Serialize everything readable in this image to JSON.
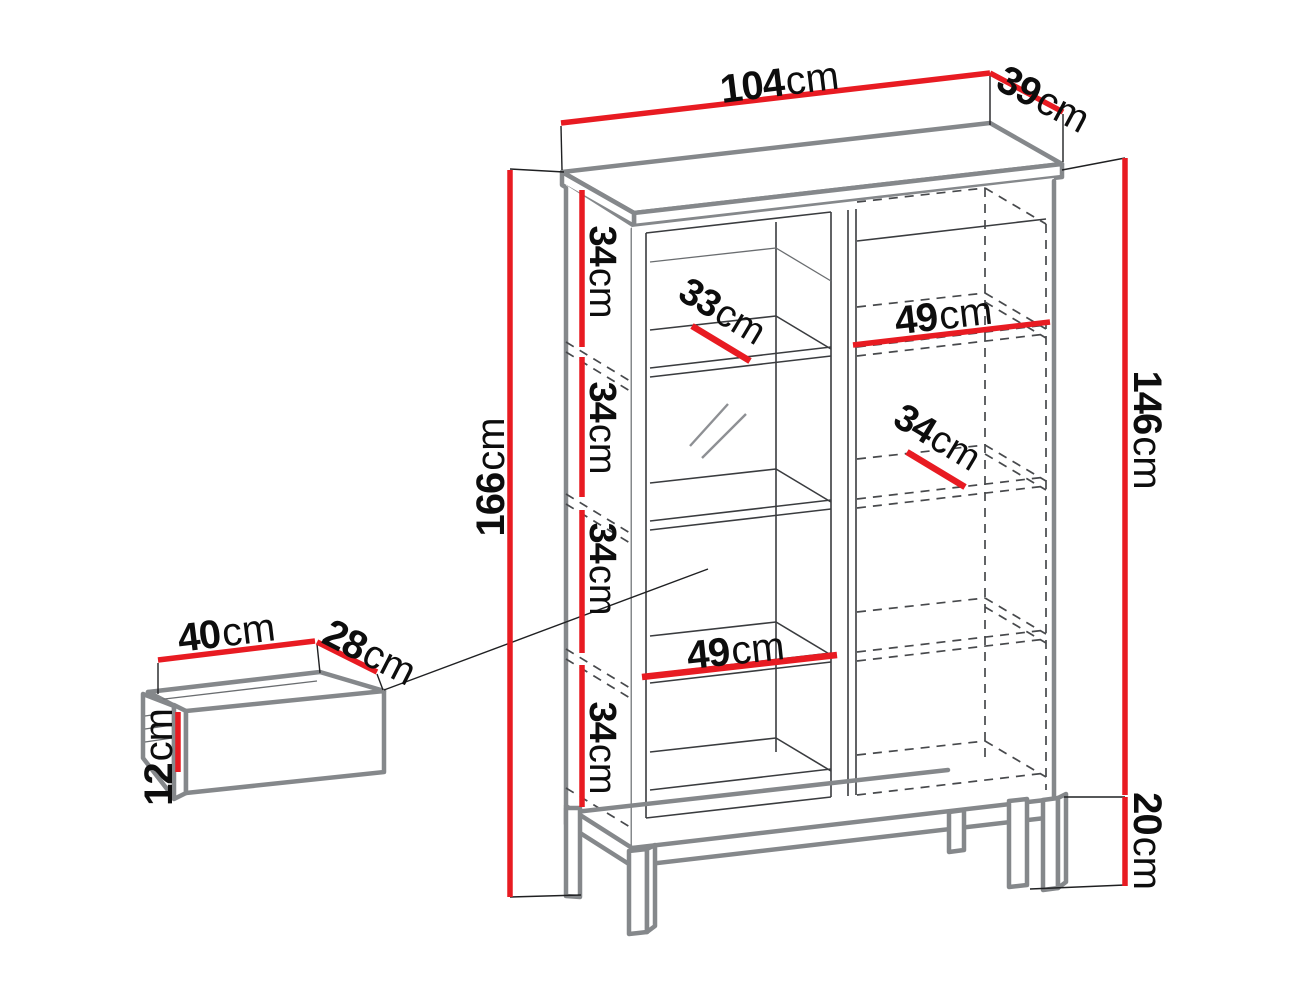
{
  "diagram": {
    "type": "furniture-dimension-diagram",
    "unit": "cm",
    "cabinet": {
      "top_width": {
        "value": "104",
        "unit": "cm"
      },
      "top_depth": {
        "value": "39",
        "unit": "cm"
      },
      "total_height": {
        "value": "166",
        "unit": "cm"
      },
      "body_height": {
        "value": "146",
        "unit": "cm"
      },
      "base_height": {
        "value": "20",
        "unit": "cm"
      },
      "shelf_spacings": [
        {
          "value": "34",
          "unit": "cm"
        },
        {
          "value": "34",
          "unit": "cm"
        },
        {
          "value": "34",
          "unit": "cm"
        },
        {
          "value": "34",
          "unit": "cm"
        }
      ],
      "glass_shelf_depth": {
        "value": "33",
        "unit": "cm"
      },
      "right_section_width": {
        "value": "49",
        "unit": "cm"
      },
      "right_shelf_depth": {
        "value": "34",
        "unit": "cm"
      },
      "left_section_width": {
        "value": "49",
        "unit": "cm"
      }
    },
    "drawer": {
      "width": {
        "value": "40",
        "unit": "cm"
      },
      "depth": {
        "value": "28",
        "unit": "cm"
      },
      "height": {
        "value": "12",
        "unit": "cm"
      }
    },
    "colors": {
      "dimension": "#e81b22",
      "outline": "#85888b",
      "detail": "#3a3c3f",
      "background": "#ffffff"
    }
  }
}
